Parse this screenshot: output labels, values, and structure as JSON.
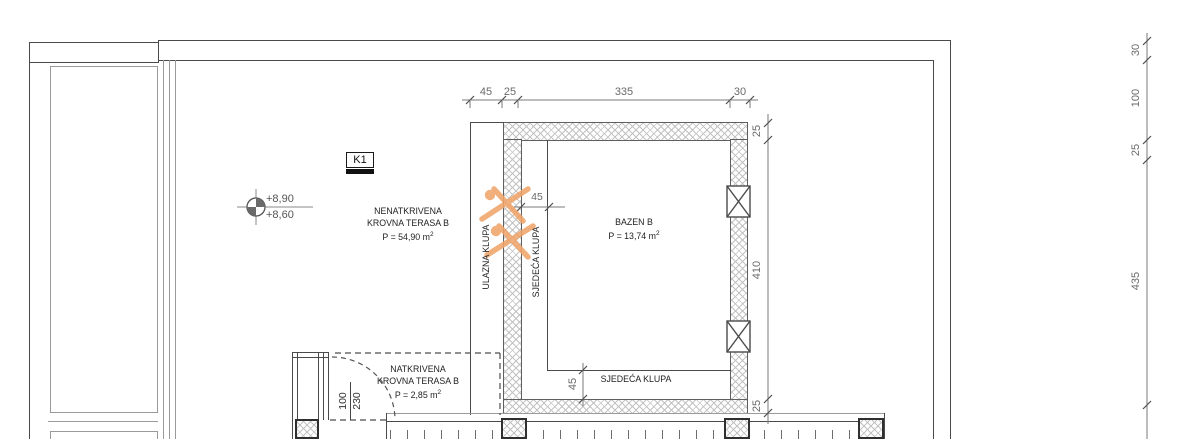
{
  "labels": {
    "k1": "K1",
    "level_upper": "+8,90",
    "level_lower": "+8,60",
    "uncovered_terrace": {
      "line1": "NENATKRIVENA",
      "line2": "KROVNA TERASA B",
      "area": "P = 54,90 m",
      "area_sup": "2"
    },
    "covered_terrace": {
      "line1": "NATKRIVENA",
      "line2": "KROVNA TERASA B",
      "area": "P = 2,85 m",
      "area_sup": "2"
    },
    "pool": {
      "name": "BAZEN B",
      "area": "P = 13,74 m",
      "area_sup": "2"
    },
    "entry_bench": "ULAZNA KLUPA",
    "seat_bench_left": "SJEDEĆA KLUPA",
    "seat_bench_bottom": "SJEDEĆA KLUPA"
  },
  "dimensions": {
    "top": [
      "45",
      "25",
      "335",
      "30"
    ],
    "pool_right": [
      "25",
      "410",
      "25"
    ],
    "far_right": [
      "30",
      "100",
      "25",
      "435"
    ],
    "bench_width_top": "45",
    "bench_width_bottom": "45",
    "door_width": "100",
    "door_height": "230"
  },
  "colors": {
    "swimmer_orange": "#f0a469",
    "hatch_line": "#c3c3c3",
    "wall_line_dark": "#4a4a4a",
    "wall_line_gray": "#9a9a9a",
    "dimension_text": "#6a6a6a"
  }
}
